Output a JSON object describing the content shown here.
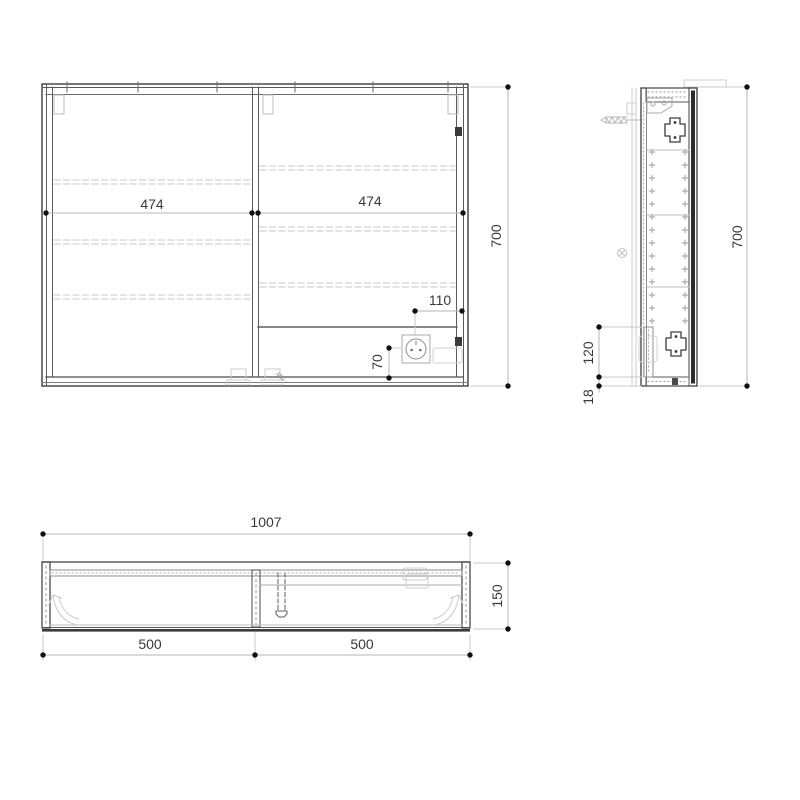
{
  "drawing_title": "cabinet-three-view-technical-drawing",
  "front_view": {
    "width_left": "474",
    "width_right": "474",
    "socket_offset_x": "110",
    "socket_offset_y": "70",
    "height": "700"
  },
  "side_view": {
    "height": "700",
    "compartment_height": "120",
    "panel_thickness": "18"
  },
  "top_view": {
    "total_width": "1007",
    "left_section": "500",
    "right_section": "500",
    "depth": "150"
  },
  "colors": {
    "line_dark": "#3d3d3d",
    "line_medium": "#8c8c8c",
    "line_light": "#c8c8c8",
    "dimension_line": "#b4b4b4",
    "dimension_dot": "#111111",
    "text": "#3a3a3a",
    "background": "#ffffff"
  }
}
